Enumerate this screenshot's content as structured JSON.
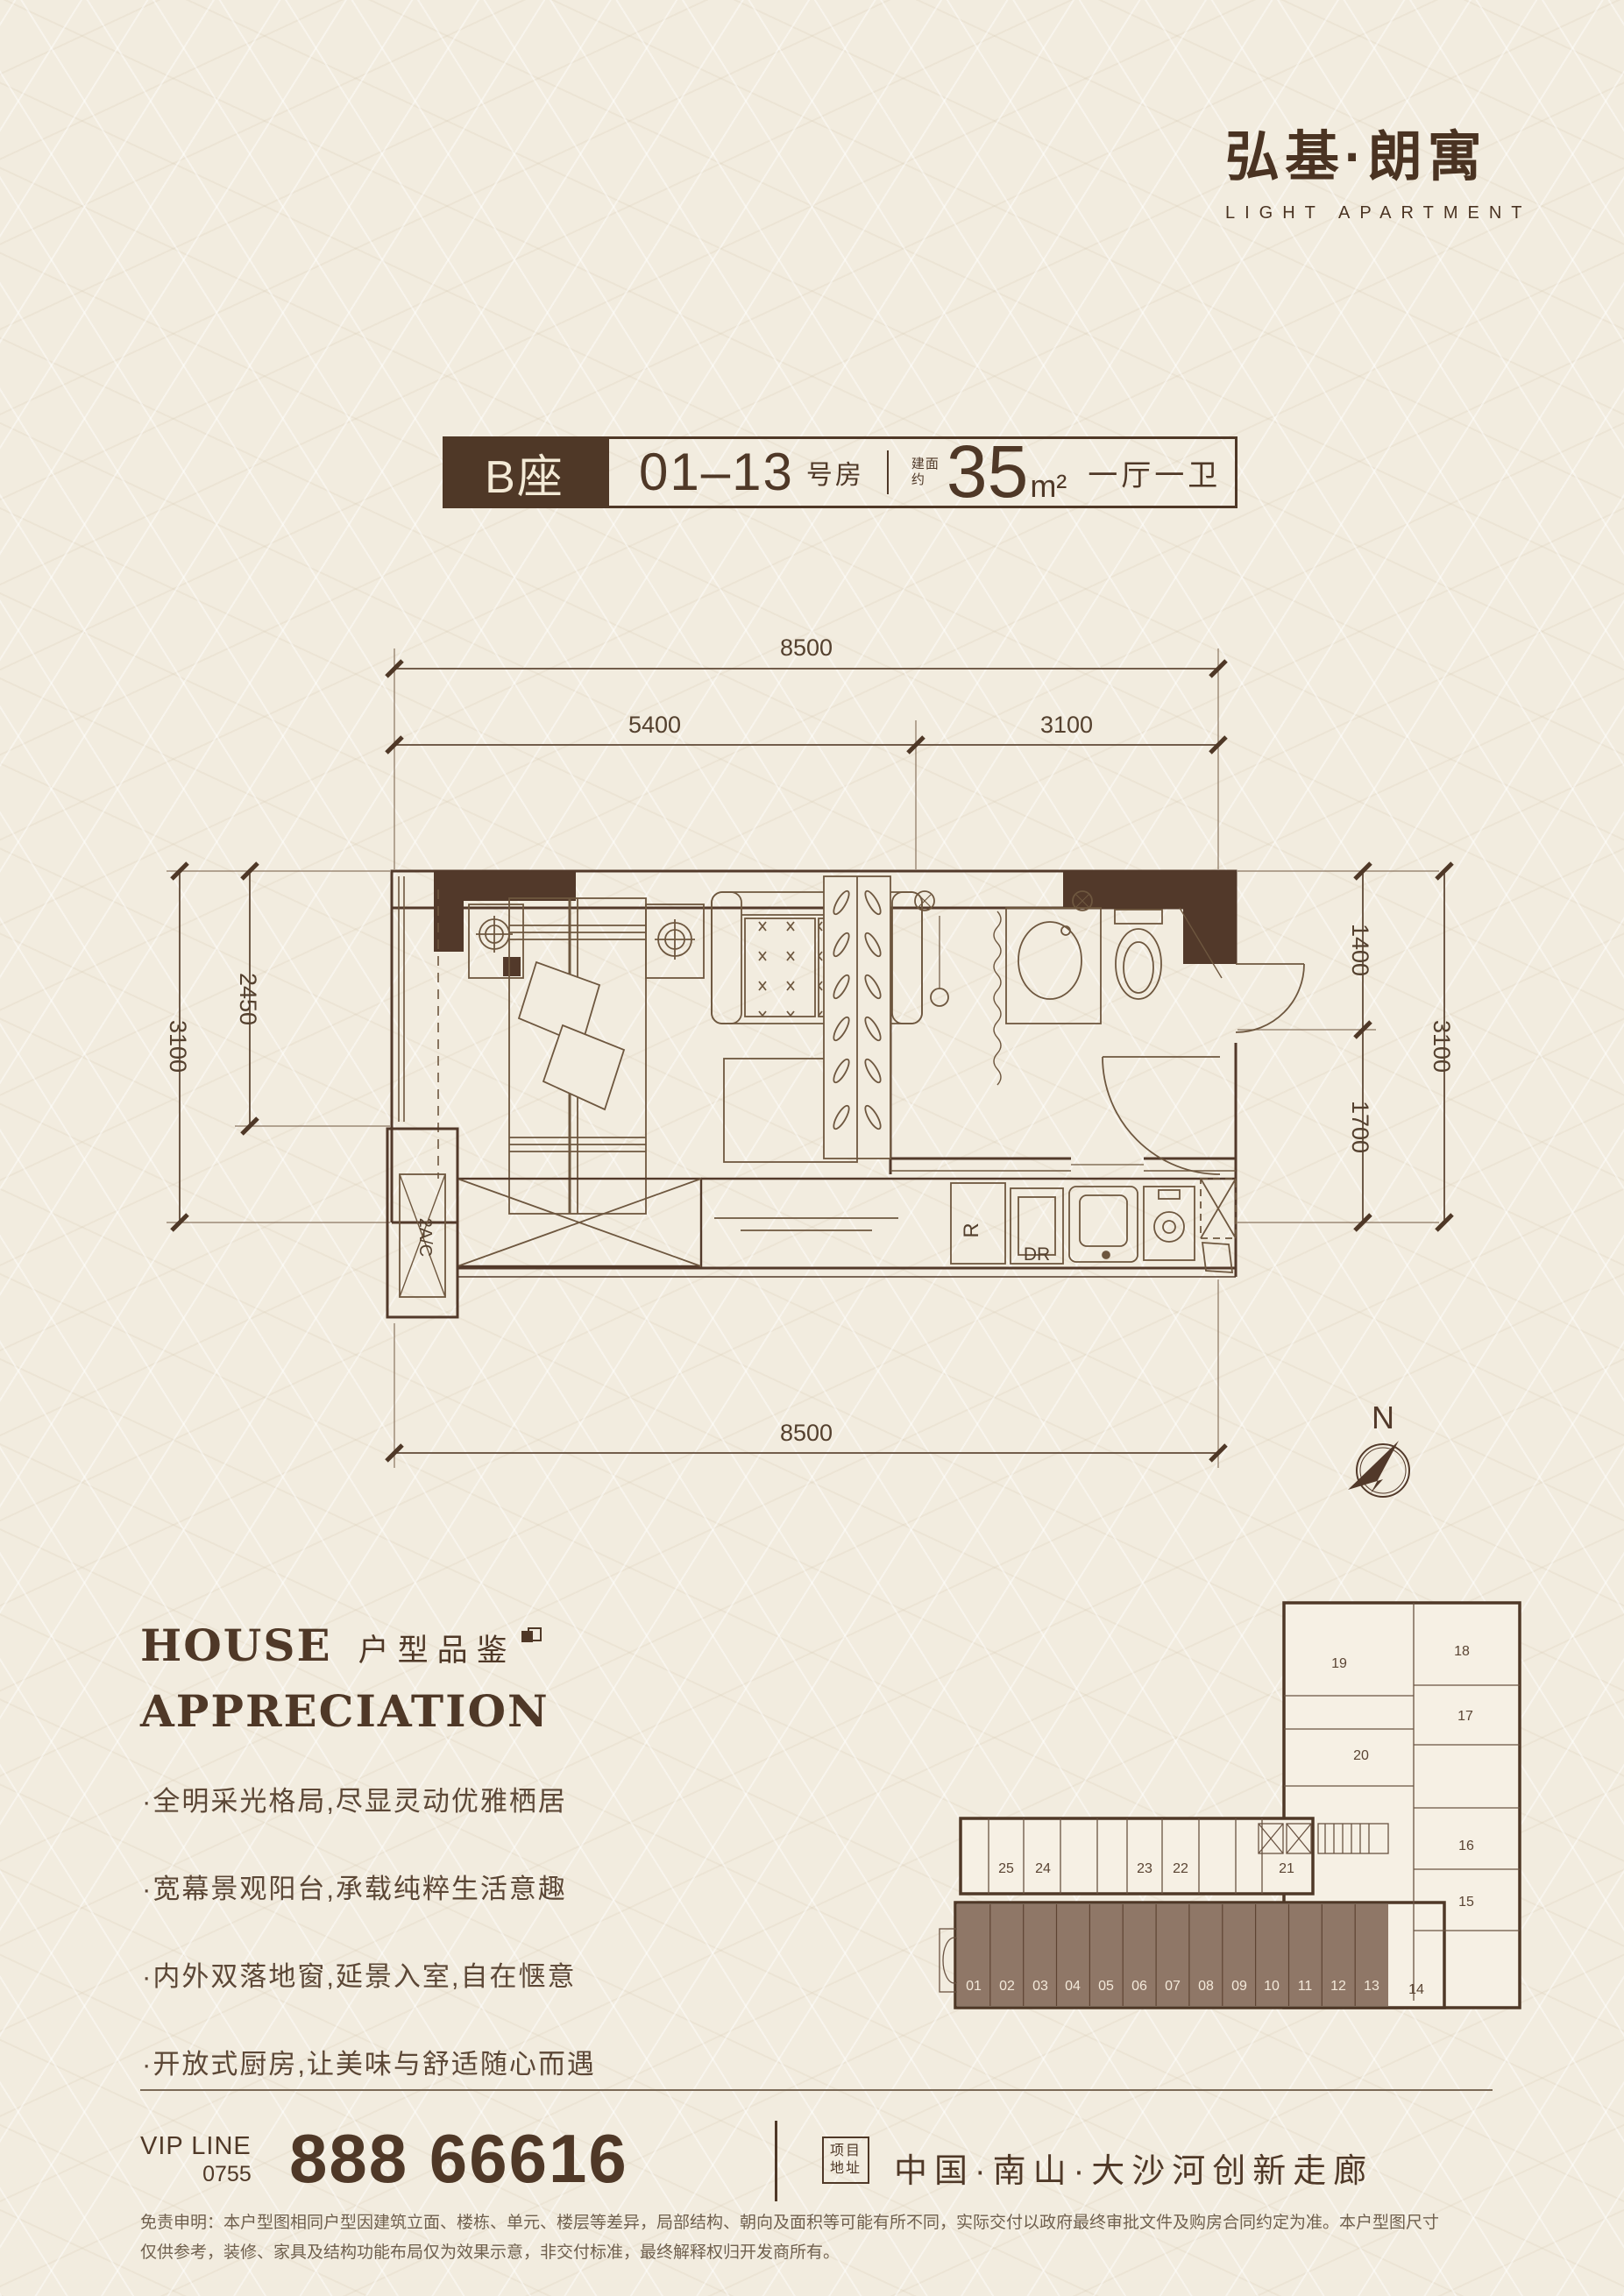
{
  "logo": {
    "title": "弘基·朗寓",
    "subtitle": "LIGHT APARTMENT"
  },
  "title_bar": {
    "block": "B座",
    "range": "01–13",
    "range_suffix": "号房",
    "area_prefix_1": "建面",
    "area_prefix_2": "约",
    "area_value": "35",
    "area_unit": "m²",
    "layout": "一厅一卫"
  },
  "floor_plan": {
    "dims": {
      "top_total": "8500",
      "top_left": "5400",
      "top_right": "3100",
      "left_outer": "3100",
      "left_inner": "2450",
      "right_top": "1400",
      "right_bottom": "1700",
      "right_outer": "3100",
      "bottom_total": "8500"
    },
    "labels": {
      "ac_unit": "2A/C",
      "fridge": "R",
      "dryer": "DR"
    },
    "compass_n": "N"
  },
  "appreciation": {
    "en_line1": "HOUSE",
    "en_line2": "APPRECIATION",
    "cn": "户型品鉴",
    "bullets": [
      "·全明采光格局,尽显灵动优雅栖居",
      "·宽幕景观阳台,承载纯粹生活意趣",
      "·内外双落地窗,延景入室,自在惬意",
      "·开放式厨房,让美味与舒适随心而遇"
    ]
  },
  "site_plan": {
    "bottom_units": [
      "01",
      "02",
      "03",
      "04",
      "05",
      "06",
      "07",
      "08",
      "09",
      "10",
      "11",
      "12",
      "13"
    ],
    "unit_14": "14",
    "middle_units": [
      "25",
      "24",
      "23",
      "22",
      "21"
    ],
    "wing_units": [
      "19",
      "18",
      "17",
      "20",
      "16",
      "15"
    ]
  },
  "contact": {
    "vip_label": "VIP LINE",
    "vip_code": "0755",
    "vip_number": "888 66616",
    "addr_label_1": "项目",
    "addr_label_2": "地址",
    "address": "中国·南山·大沙河创新走廊"
  },
  "disclaimer": {
    "line1": "免责申明：本户型图相同户型因建筑立面、楼栋、单元、楼层等差异，局部结构、朝向及面积等可能有所不同，实际交付以政府最终审批文件及购房合同约定为准。本户型图尺寸",
    "line2": "仅供参考，装修、家具及结构功能布局仅为效果示意，非交付标准，最终解释权归开发商所有。"
  }
}
